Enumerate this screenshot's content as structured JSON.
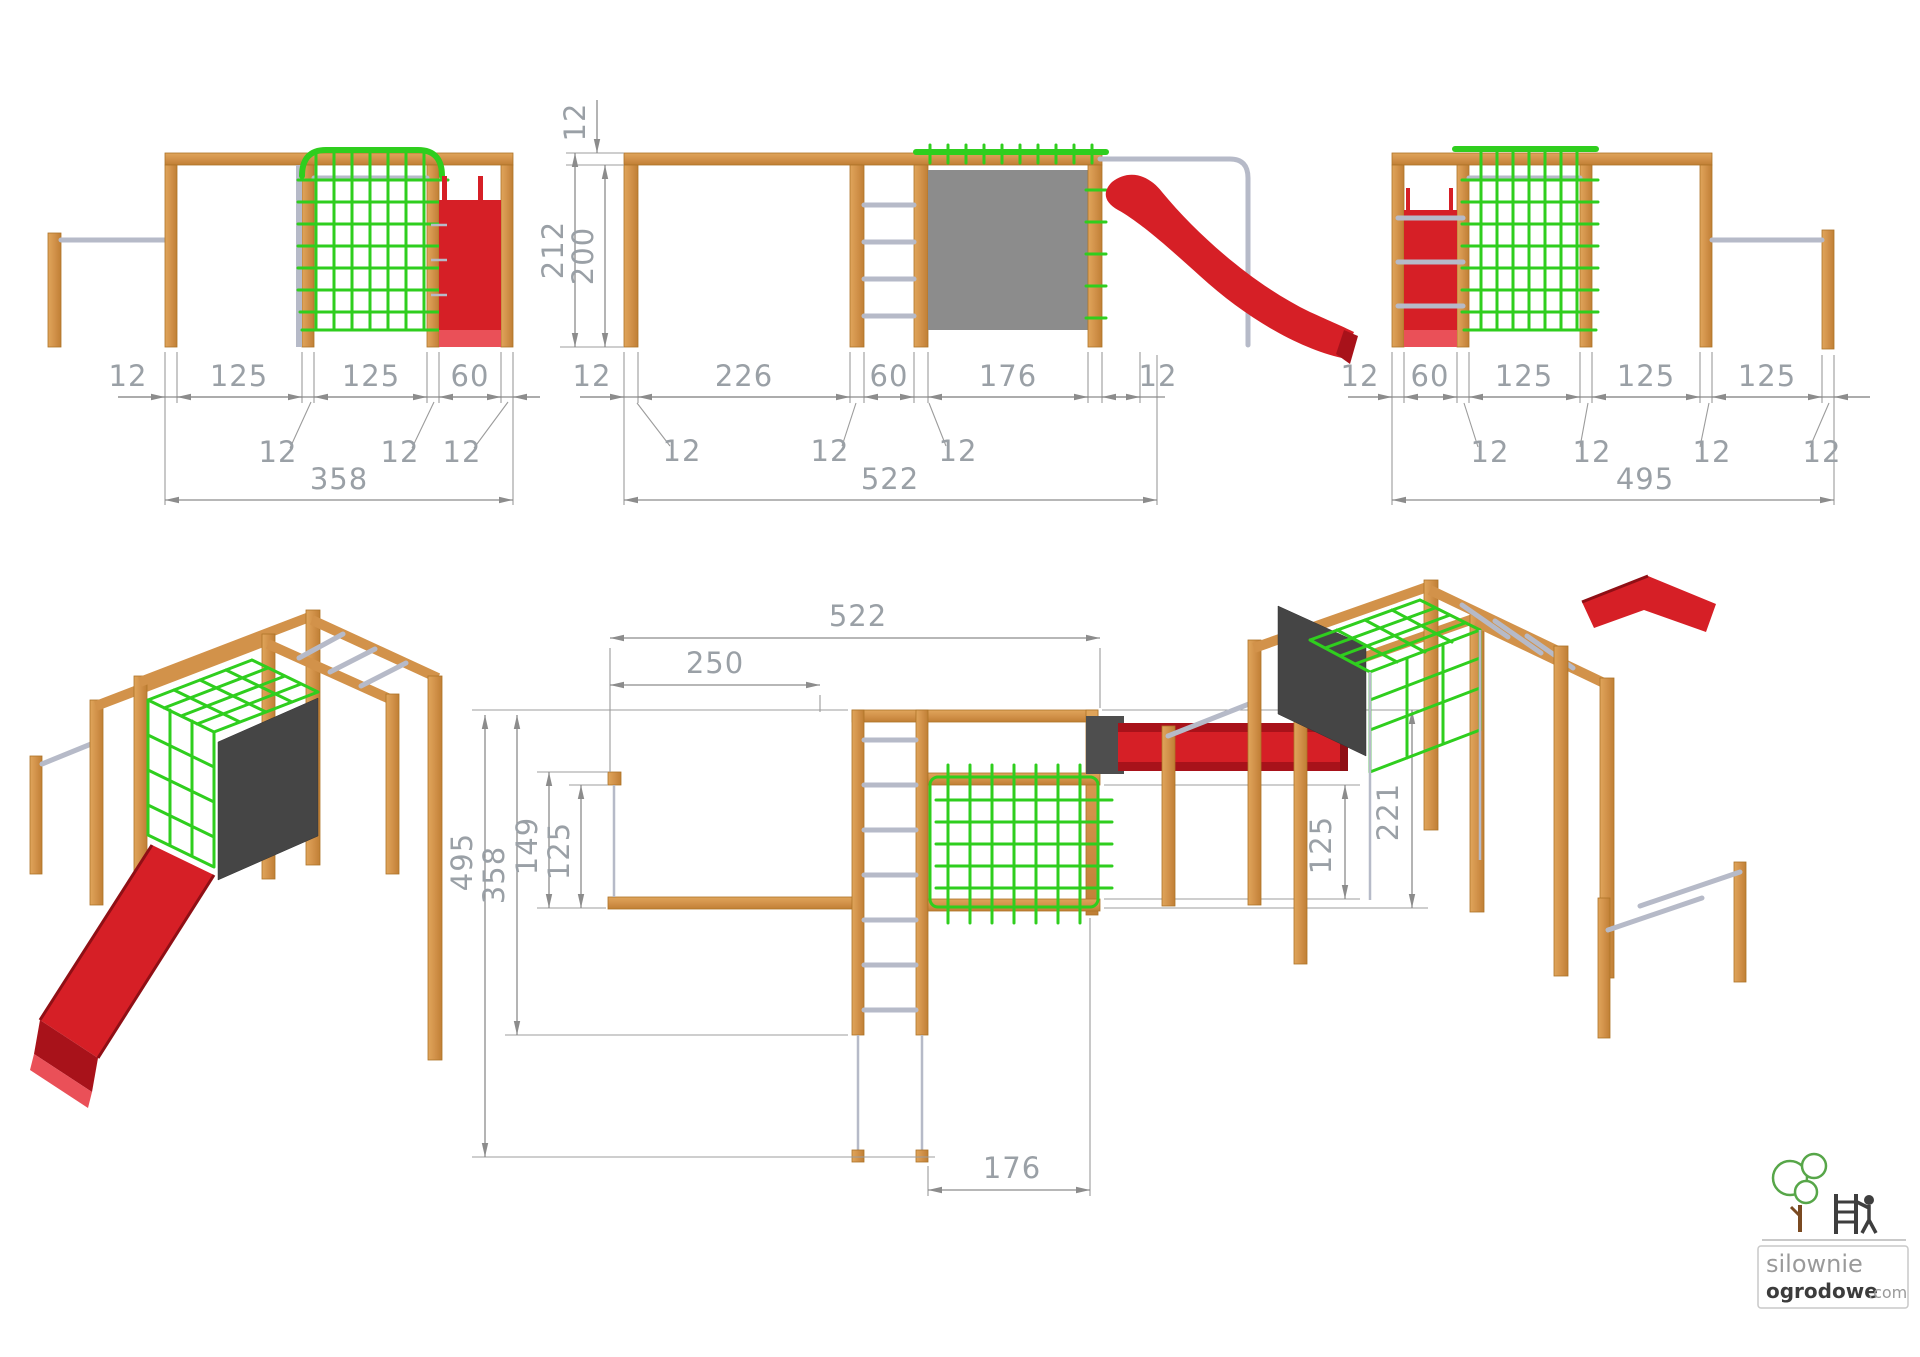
{
  "views": {
    "front": {
      "row": [
        "12",
        "125",
        "125",
        "60"
      ],
      "callouts": [
        "12",
        "12",
        "12"
      ],
      "total": "358"
    },
    "side": {
      "vertical": [
        "12",
        "212",
        "200"
      ],
      "row": [
        "12",
        "226",
        "60",
        "176",
        "12"
      ],
      "callouts": [
        "12",
        "12",
        "12"
      ],
      "total": "522"
    },
    "back": {
      "row": [
        "12",
        "60",
        "125",
        "125",
        "125"
      ],
      "callouts": [
        "12",
        "12",
        "12",
        "12"
      ],
      "total": "495"
    },
    "plan": {
      "top": "522",
      "inner_top": "250",
      "left": [
        "495",
        "358",
        "149",
        "125"
      ],
      "right": [
        "125",
        "221"
      ],
      "bottom": "176"
    }
  },
  "logo": {
    "brand_top": "silownie",
    "brand_bottom": "ogrodowe",
    "brand_suffix": ".com"
  },
  "colors": {
    "wood": "#d2924a",
    "net_green": "#2fce1e",
    "slide_red": "#d61f26",
    "panel_gray": "#8c8c8c",
    "metal_gray": "#b6bac8",
    "dimension_gray": "#9aa0a6"
  }
}
